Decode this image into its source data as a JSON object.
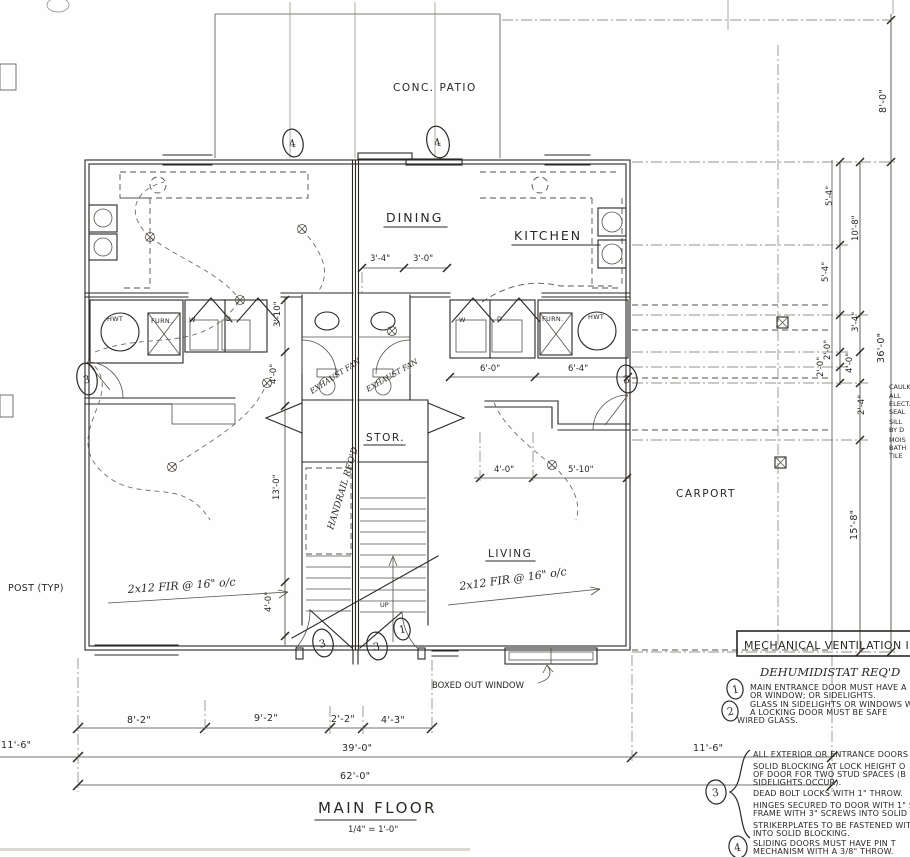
{
  "title": {
    "name": "MAIN FLOOR",
    "scale": "1/4\" = 1'-0\""
  },
  "rooms": {
    "patio": "CONC. PATIO",
    "dining": "DINING",
    "kitchen": "KITCHEN",
    "stor": "STOR.",
    "living": "LIVING",
    "carport": "CARPORT"
  },
  "fixtures": {
    "hwt": "HWT",
    "furn": "FURN.",
    "washer": "W",
    "dryer": "D"
  },
  "annotations": {
    "post": "POST (TYP)",
    "joist": "2x12 FIR @ 16\" o/c",
    "exhaust": "EXHAUST FAN",
    "handrail": "HANDRAIL REQ'D",
    "boxed_window": "BOXED OUT WINDOW",
    "up": "UP",
    "dehumid": "DEHUMIDISTAT REQ'D"
  },
  "keynotes": {
    "k1": "1",
    "k2": "2",
    "k3": "3",
    "k4": "4"
  },
  "dims": {
    "bottom": {
      "a": "8'-2\"",
      "b": "9'-2\"",
      "c": "2'-2\"",
      "d": "4'-3\"",
      "total": "39'-0\"",
      "overall": "62'-0\"",
      "left": "11'-6\"",
      "right": "11'-6\""
    },
    "right": {
      "patio": "8'-0\"",
      "a": "5'-4\"",
      "b": "10'-8\"",
      "c": "5'-4\"",
      "d": "3'-4\"",
      "e": "2'-0\"",
      "f": "2'-0\"",
      "g": "4'-0\"",
      "h": "2'-4\"",
      "total": "36'-0\"",
      "carport": "15'-8\""
    },
    "interior": {
      "a": "3'-4\"",
      "b": "3'-0\"",
      "c": "6'-0\"",
      "d": "6'-4\"",
      "e": "4'-0\"",
      "f": "5'-10\"",
      "g": "3'-10\"",
      "h": "4'-0\"",
      "i": "13'-0\"",
      "j": "4'-0\""
    }
  },
  "notes": {
    "box_title": "MECHANICAL VENTILATION IS",
    "n1": [
      "MAIN ENTRANCE DOOR MUST HAVE A",
      "OR WINDOW; OR SIDELIGHTS."
    ],
    "n2": [
      "GLASS IN SIDELIGHTS OR WINDOWS W",
      "A LOCKING DOOR MUST BE SAFE",
      "WIRED GLASS."
    ],
    "n3": [
      "ALL EXTERIOR OR ENTRANCE DOORS",
      "SOLID BLOCKING AT LOCK HEIGHT O",
      "OF DOOR FOR TWO STUD SPACES (B",
      "SIDELIGHTS OCCUR).",
      "DEAD BOLT LOCKS WITH 1\" THROW.",
      "HINGES SECURED TO DOOR WITH 1\" SC",
      "FRAME WITH 3\" SCREWS INTO SOLID",
      "STRIKERPLATES TO BE FASTENED WIT",
      "INTO SOLID BLOCKING."
    ],
    "n4": [
      "SLIDING DOORS MUST HAVE PIN T",
      "MECHANISM WITH A 3/8\" THROW."
    ]
  },
  "edge": [
    "CAULK",
    "ALL",
    "ELECT.",
    "SEAL",
    "SILL",
    "BY D",
    "MOIS",
    "BATH",
    "TILE"
  ]
}
